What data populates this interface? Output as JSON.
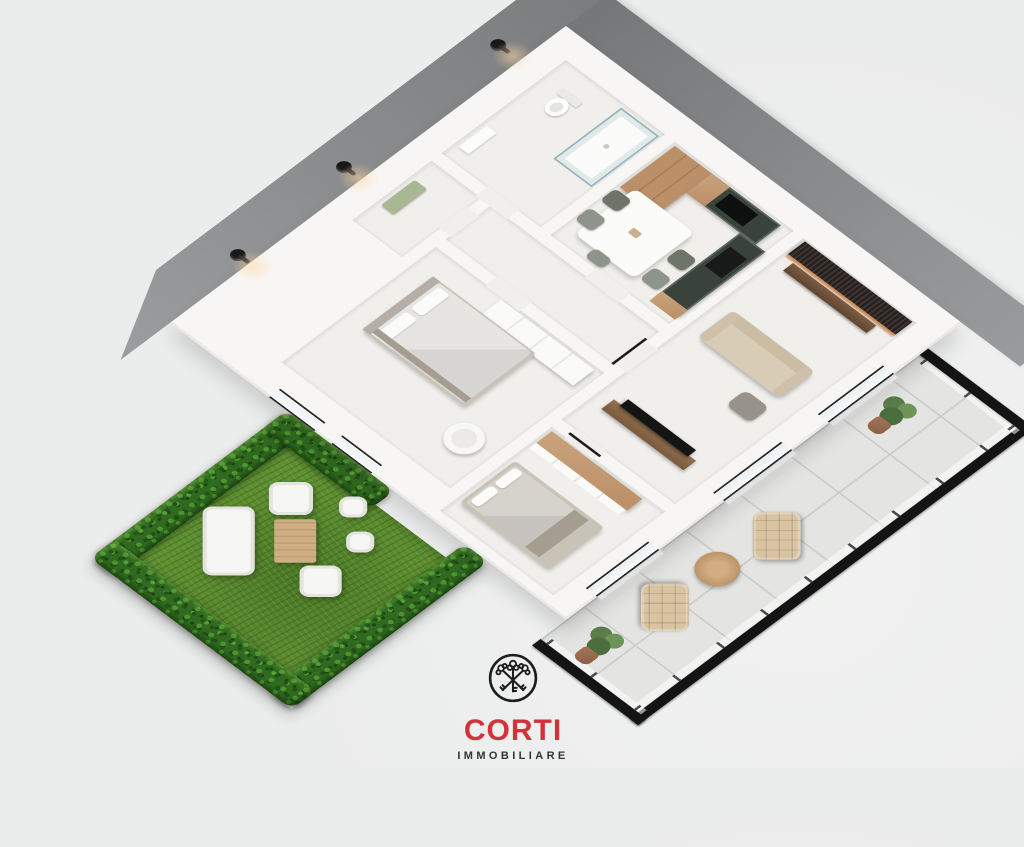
{
  "image_type": "3d-axonometric-floor-plan-render",
  "brand": {
    "name": "CORTI",
    "subtitle": "IMMOBILIARE",
    "icon": "crossed-keys-circle-icon"
  },
  "colors": {
    "background": "#ebecec",
    "background_light": "#f1f2f1",
    "exterior_band": "#7e8081",
    "wall": "#f7f6f4",
    "floor": "#f0efec",
    "grass": "#5f8f33",
    "hedge": "#306a20",
    "kitchen_cabinet": "#39433c",
    "wood": "#bb8f67",
    "wood_light": "#c9a37c",
    "sofa": "#d8ccb6",
    "lounge_chair": "#d9c4a2",
    "tile": "#e4e5e3",
    "railing": "#141414",
    "tv": "#151515",
    "slat_wall": "#2a2522",
    "led_glow": "#d68242",
    "lamp": "#181818",
    "logo_red": "#d2323a",
    "logo_text": "#333333"
  },
  "scene": {
    "exterior": [
      "dark gray perimeter wall band on the two upper faces",
      "three black wall lamps with warm glow",
      "hedge-bordered garden lawn at lower left",
      "tiled balcony with black glass railing at lower right"
    ],
    "rooms": [
      {
        "name": "bathroom",
        "furniture": [
          "toilet",
          "walk-in glass shower",
          "vanity"
        ]
      },
      {
        "name": "kitchen-dining",
        "furniture": [
          "L-shaped dark green kitchen",
          "tall wood cabinets",
          "black cooktop",
          "black sink",
          "white dining table",
          "five chairs"
        ]
      },
      {
        "name": "living-room",
        "furniture": [
          "dark wood-slat media wall with LED glow",
          "wood console",
          "beige sofa",
          "gray pouf",
          "TV on wood sideboard"
        ]
      },
      {
        "name": "bedroom-1",
        "furniture": [
          "double bed",
          "white wardrobe",
          "white tub chair",
          "green bench"
        ]
      },
      {
        "name": "bedroom-2",
        "furniture": [
          "double bed",
          "wood-top wardrobe"
        ]
      },
      {
        "name": "hallway",
        "furniture": []
      }
    ],
    "garden_furniture": [
      "white outdoor sofa",
      "two white armchairs",
      "two white side stools",
      "wood plank coffee table"
    ],
    "balcony_furniture": [
      "two beige tufted lounge chairs",
      "round wood side table",
      "two potted plants"
    ]
  }
}
